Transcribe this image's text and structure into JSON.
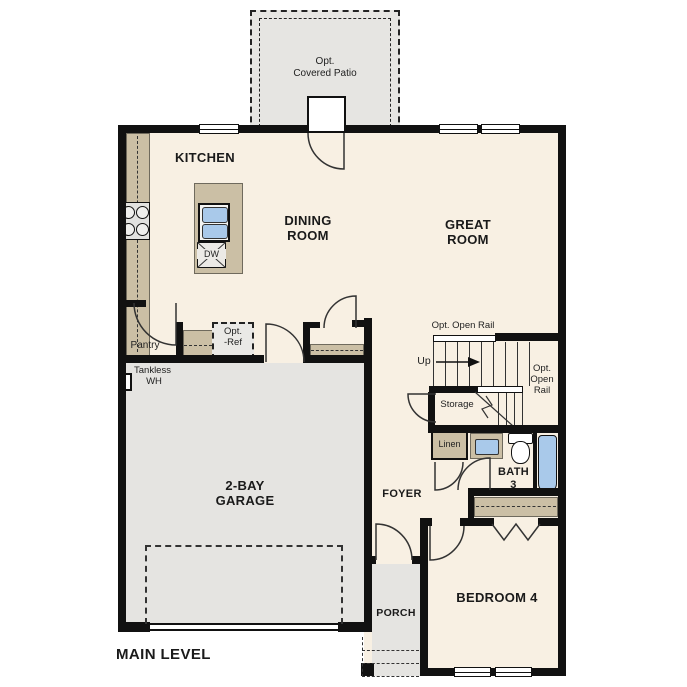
{
  "title": "MAIN LEVEL",
  "colors": {
    "wall": "#111111",
    "floor": "#f8f0e3",
    "counter": "#cbbfa5",
    "exterior_concrete": "#e5e4e1",
    "fixture_blue": "#a9c9ea"
  },
  "rooms": {
    "patio": {
      "lines": [
        "Opt.",
        "Covered Patio"
      ]
    },
    "kitchen": {
      "label": "KITCHEN"
    },
    "dining_room": {
      "lines": [
        "DINING",
        "ROOM"
      ]
    },
    "great_room": {
      "lines": [
        "GREAT",
        "ROOM"
      ]
    },
    "pantry": {
      "label": "Pantry"
    },
    "garage": {
      "lines": [
        "2-BAY",
        "GARAGE"
      ]
    },
    "foyer": {
      "label": "FOYER"
    },
    "storage": {
      "label": "Storage"
    },
    "bath3": {
      "lines": [
        "BATH",
        "3"
      ]
    },
    "linen": {
      "label": "Linen"
    },
    "bedroom4": {
      "label": "BEDROOM 4"
    },
    "porch": {
      "label": "PORCH"
    }
  },
  "annotations": {
    "opt_ref": {
      "lines": [
        "Opt.",
        "-Ref"
      ]
    },
    "tankless_wh": {
      "lines": [
        "Tankless",
        "WH"
      ]
    },
    "open_rail_top": {
      "label": "Opt. Open Rail"
    },
    "open_rail_right": {
      "lines": [
        "Opt.",
        "Open",
        "Rail"
      ]
    },
    "up": {
      "label": "Up"
    },
    "dishwasher": {
      "label": "DW"
    }
  }
}
